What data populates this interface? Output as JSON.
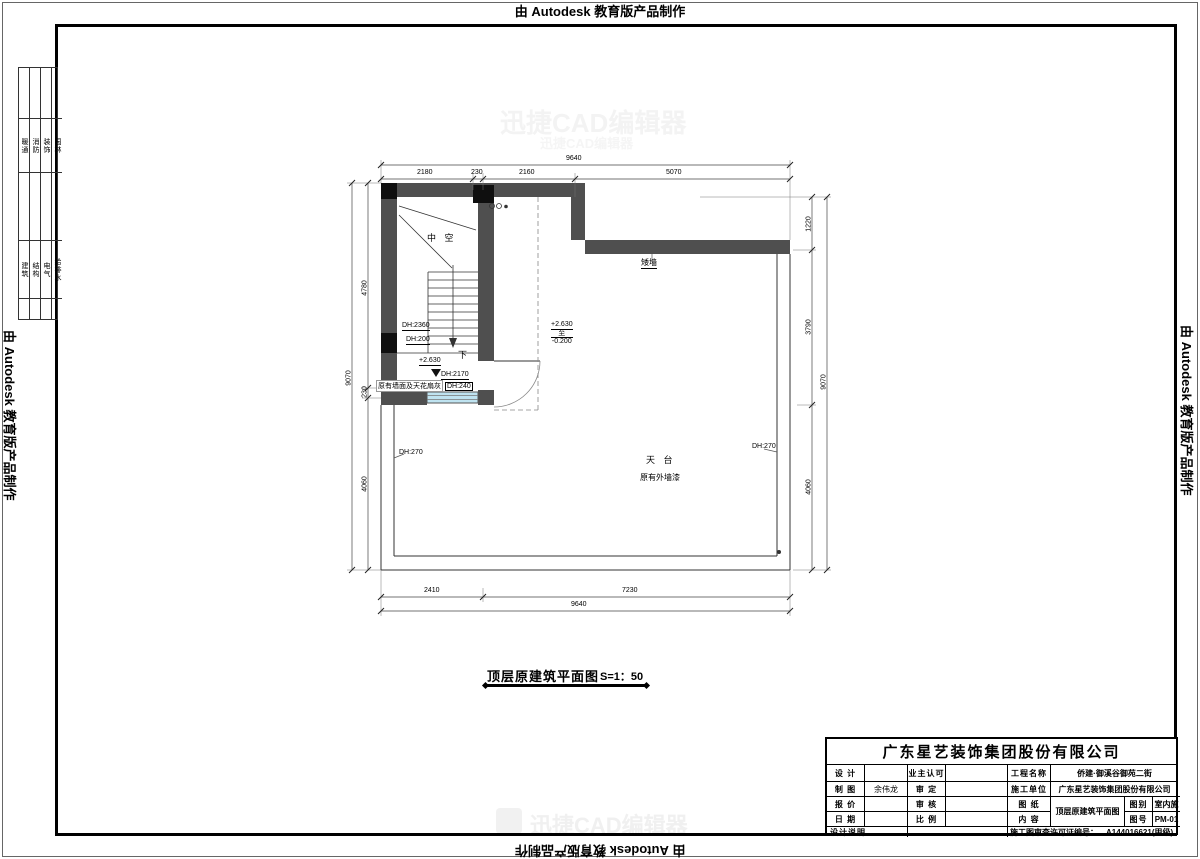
{
  "banners": {
    "edge_text": "由 Autodesk 教育版产品制作"
  },
  "disciplines": {
    "group1": [
      "暖通",
      "消防",
      "装饰",
      "园林"
    ],
    "group2": [
      "建筑",
      "结构",
      "电气",
      "给排水"
    ]
  },
  "plan_labels": {
    "void": "中 空",
    "down": "下",
    "low_wall": "矮墙",
    "terrace": "天 台",
    "terrace_note": "原有外墙漆",
    "wall_note": "原有墙面及天花扇灰",
    "level_landing": "+2.630",
    "level_top": "+2.630",
    "level_mid": "至",
    "level_bottom": "-0.200",
    "dh2360": "DH:2360",
    "dh200": "DH:200",
    "dh2170": "DH:2170",
    "dh240": "DH:240",
    "dh270_left": "DH:270",
    "dh270_right": "DH:270"
  },
  "dims": {
    "top_total": "9640",
    "top_s1": "2180",
    "top_s2": "230",
    "top_s3": "2160",
    "top_s4": "5070",
    "bottom_s1": "2410",
    "bottom_s2": "7230",
    "bottom_total": "9640",
    "left_outer": "9070",
    "left_s1": "4780",
    "left_s2": "230",
    "left_s3": "4060",
    "right_s1": "1220",
    "right_s2": "3790",
    "right_s3": "4060",
    "right_outer": "9070"
  },
  "drawing_title": {
    "text": "顶层原建筑平面图",
    "scale": "S=1：50"
  },
  "title_block": {
    "company": "广东星艺装饰集团股份有限公司",
    "design_label": "设 计",
    "design_value": "",
    "drawn_label": "制 图",
    "drawn_value": "余伟龙",
    "quote_label": "报 价",
    "quote_value": "",
    "date_label": "日 期",
    "date_value": "",
    "notes_label": "设计说明",
    "owner_label": "业主认可",
    "owner_value": "",
    "approve_label": "审 定",
    "approve_value": "",
    "check_label": "审 核",
    "check_value": "",
    "scale_label": "比 例",
    "scale_value": "",
    "project_label": "工程名称",
    "project_value": "侨建·御溪谷御苑二街",
    "builder_label": "施工单位",
    "builder_value": "广东星艺装饰集团股份有限公司",
    "sheet_label": "图 纸",
    "content_label": "内 容",
    "sheet_value": "顶层原建筑平面图",
    "category_label": "图别",
    "category_value": "室内施",
    "number_label": "图号",
    "number_value": "PM-01",
    "cert_label": "施工图审查许可证编号：",
    "cert_value": "A144016621(甲级)"
  },
  "watermark": {
    "text": "迅捷CAD编辑器"
  }
}
